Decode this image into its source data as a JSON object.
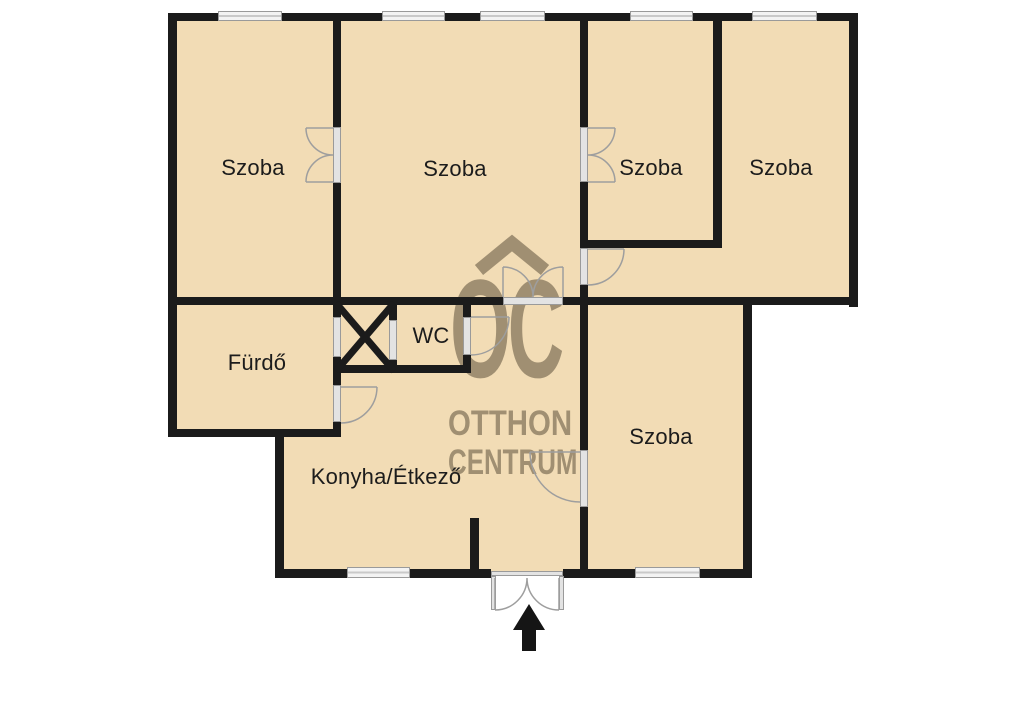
{
  "watermark": {
    "initials": "OC",
    "line1": "OTTHON",
    "line2": "CENTRUM"
  },
  "rooms": {
    "room_top_left": {
      "label": "Szoba"
    },
    "room_top_center": {
      "label": "Szoba"
    },
    "room_top_right_inner": {
      "label": "Szoba"
    },
    "room_top_right_outer": {
      "label": "Szoba"
    },
    "room_bottom_right": {
      "label": "Szoba"
    },
    "bathroom": {
      "label": "Fürdő"
    },
    "wc": {
      "label": "WC"
    },
    "kitchen_dining": {
      "label": "Konyha/Étkező"
    }
  },
  "colors": {
    "background": "#ffffff",
    "floor": "#f2dcb5",
    "wall": "#1b1b1b",
    "window_frame": "#9a9a9a",
    "door_opening": "#e3e3e3",
    "door_arc": "#9e9e9e",
    "watermark": "#a08f72",
    "label_text": "#1c1c1c",
    "entrance_arrow": "#151515"
  }
}
